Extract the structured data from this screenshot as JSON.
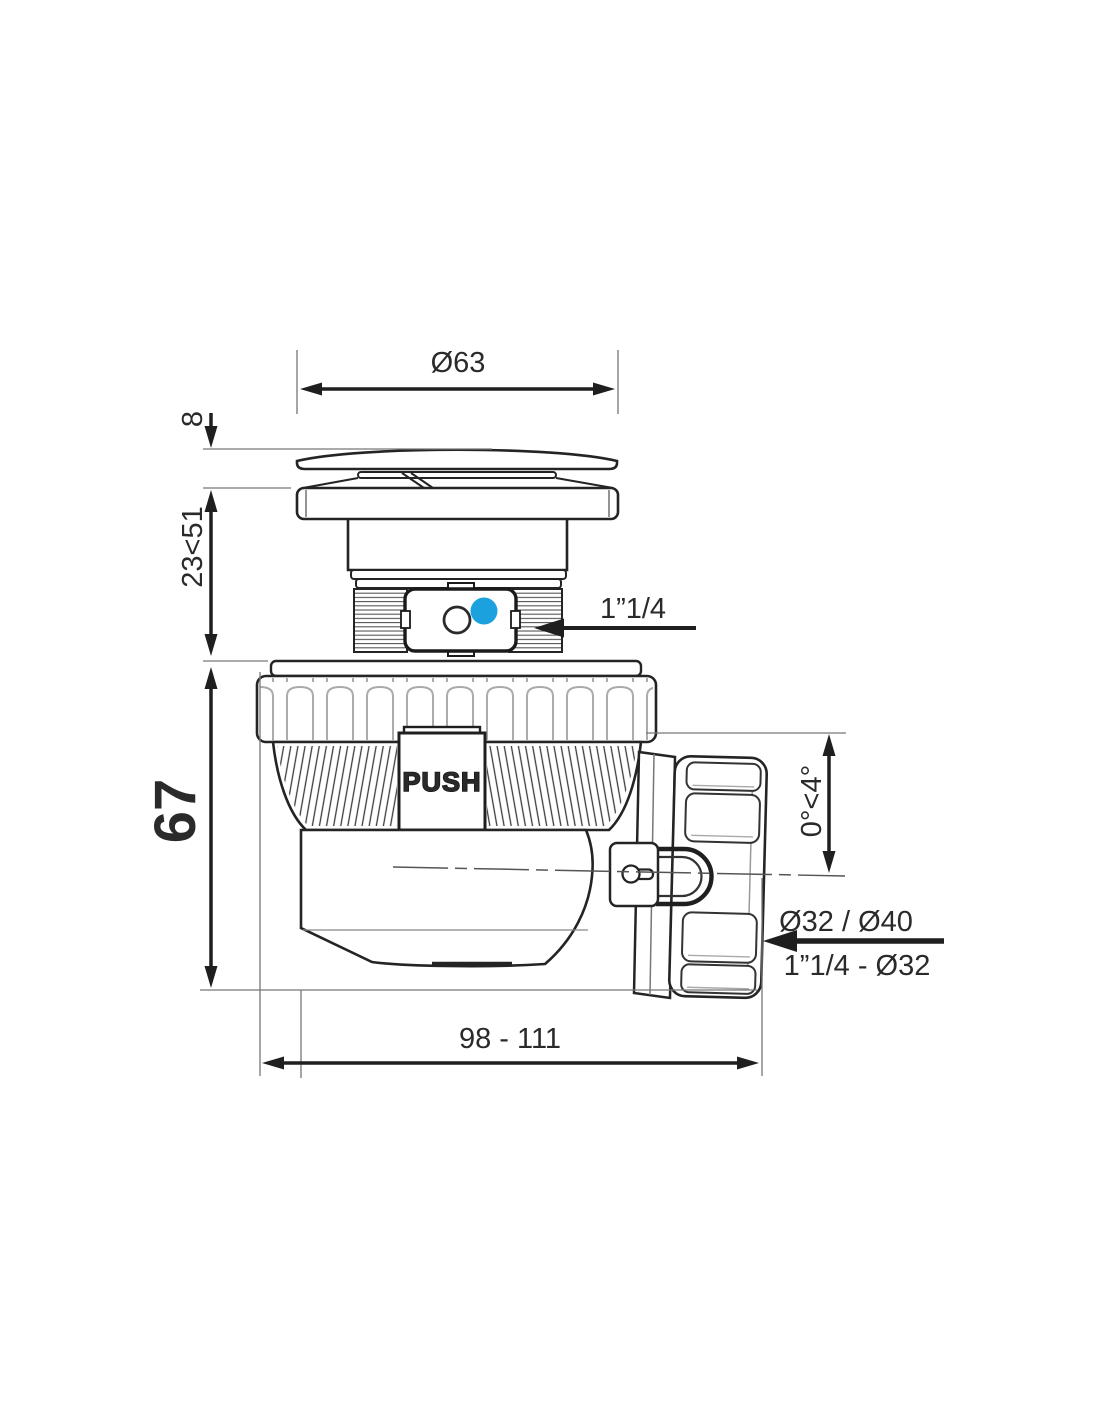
{
  "drawing": {
    "title": "push-open bottle trap technical drawing",
    "labels": {
      "dia_top": "Ø63",
      "cap_thickness": "8",
      "install_depth": "23<51",
      "body_height": "67",
      "inlet_thread": "1”1/4",
      "push": "PUSH",
      "tilt_range": "0°<4°",
      "outlet_dia": "Ø32 / Ø40",
      "outlet_thread": "1”1/4 - Ø32",
      "total_length": "98 - 111"
    },
    "colors": {
      "line": "#242424",
      "thin_line": "#777777",
      "accent_blue": "#1BA1DD"
    }
  }
}
